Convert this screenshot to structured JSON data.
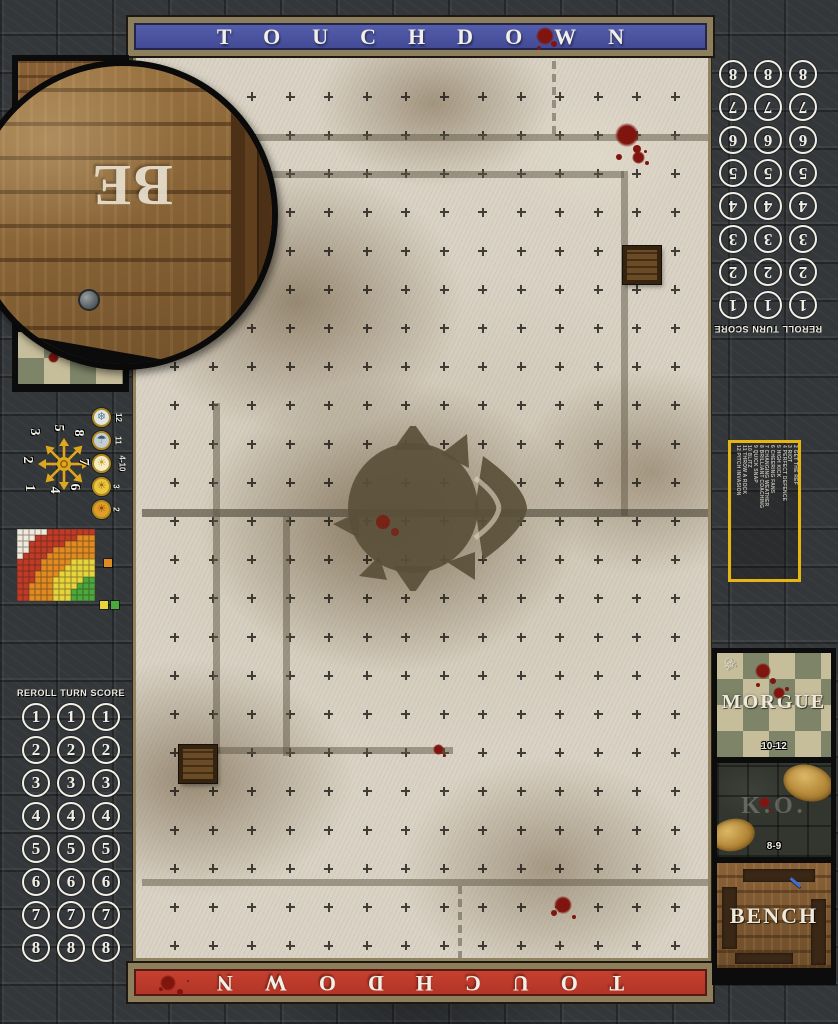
{
  "banners": {
    "top": "TOUCHDOWN",
    "bottom": "TOUCHDOWN"
  },
  "score_track": {
    "header": {
      "reroll": "REROLL",
      "turn": "TURN",
      "score": "SCORE"
    },
    "rows": [
      "1",
      "2",
      "3",
      "4",
      "5",
      "6",
      "7",
      "8"
    ],
    "columns_per_row": 3
  },
  "weather_track": {
    "entries": [
      {
        "value": "12",
        "icon": "blizzard-icon",
        "glyph": "❄",
        "bg": "#dfe6e8",
        "fg": "#5a7a88"
      },
      {
        "value": "11",
        "icon": "rain-icon",
        "glyph": "☂",
        "bg": "#c2cdd4",
        "fg": "#3e5a68"
      },
      {
        "value": "4-10",
        "icon": "perfect-weather-icon",
        "glyph": "☀",
        "bg": "#f4ecc4",
        "fg": "#c89a20"
      },
      {
        "value": "3",
        "icon": "sunny-icon",
        "glyph": "☀",
        "bg": "#e9c63e",
        "fg": "#9a6d10"
      },
      {
        "value": "2",
        "icon": "sweltering-heat-icon",
        "glyph": "☀",
        "bg": "#e29c28",
        "fg": "#8a4e08"
      }
    ]
  },
  "scatter_template": {
    "directions": [
      "1",
      "2",
      "3",
      "4",
      "5",
      "6",
      "7",
      "8"
    ]
  },
  "range_ruler": {
    "cols": 13,
    "rows": 12,
    "bands": [
      {
        "name": "quick-pass",
        "color": "#4ca83c",
        "max": 3.4
      },
      {
        "name": "short-pass",
        "color": "#e6d43c",
        "max": 6.8
      },
      {
        "name": "long-pass",
        "color": "#e08a22",
        "max": 10.2
      },
      {
        "name": "long-bomb",
        "color": "#c03a28",
        "max": 13.6
      },
      {
        "name": "out-of-range",
        "color": "#efeade",
        "max": 99
      }
    ],
    "legend_colors": [
      "#e08a22",
      "#e6d43c",
      "#4ca83c"
    ]
  },
  "kickoff_table": {
    "lines": [
      "2 GET THE REF",
      "3 RIOT",
      "4 PERFECT DEFENCE",
      "5 HIGH KICK",
      "6 CHEERING FANS",
      "7 CHANGING WEATHER",
      "8 BRILLIANT COACHING",
      "9 QUICK SNAP",
      "10 BLITZ",
      "11 THROW A ROCK",
      "12 PITCH INVASION"
    ]
  },
  "dugout": {
    "morgue": {
      "label": "MORGUE",
      "range": "10-12"
    },
    "ko": {
      "label": "K.O.",
      "range": "8-9"
    },
    "bench": {
      "label": "BENCH"
    },
    "magnifier_letters": "BE"
  },
  "colors": {
    "banner_blue": "#4a53a3",
    "banner_red": "#bf3a2b",
    "frame_tan": "#8f815d",
    "accent_yellow": "#e7b512",
    "star_yellow": "#dfa71c",
    "blood_red": "#7f150e"
  }
}
